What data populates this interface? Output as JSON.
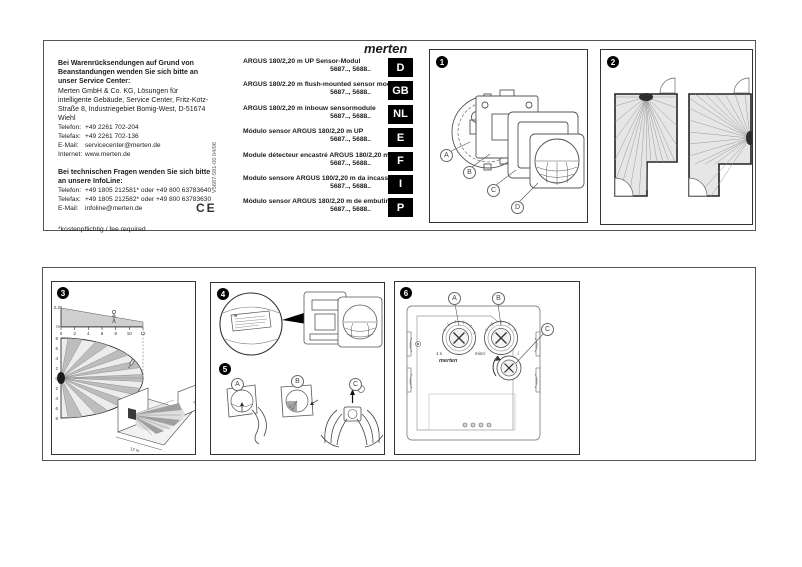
{
  "doc": {
    "vertical_code": "V5687-581-00  04/06",
    "ce_mark": "CE",
    "brand_logo": "merten"
  },
  "service_block": {
    "returns_header": "Bei Warenrücksendungen auf Grund von Beanstandungen wenden Sie sich bitte an unser Service Center:",
    "address": "Merten GmbH & Co. KG, Lösungen für intelligente Gebäude, Service Center, Fritz-Kotz-Straße 8, Industriegebiet Bomig-West, D-51674 Wiehl",
    "contacts": [
      {
        "label": "Telefon:",
        "value": "+49 2261 702-204"
      },
      {
        "label": "Telefax:",
        "value": "+49 2261 702-136"
      },
      {
        "label": "E-Mail:",
        "value": "servicecenter@merten.de"
      },
      {
        "label": "Internet:",
        "value": "www.merten.de"
      }
    ],
    "infoline_header": "Bei technischen Fragen wenden Sie sich bitte an unsere InfoLine:",
    "infoline_contacts": [
      {
        "label": "Telefon:",
        "value": "+49 1805 212581* oder +49 800 63783640"
      },
      {
        "label": "Telefax:",
        "value": "+49 1805 212582* oder +49 800 63783630"
      },
      {
        "label": "E-Mail:",
        "value": "infoline@merten.de"
      }
    ],
    "footnote": "*kostenpflichtig / fee required"
  },
  "products": [
    {
      "name": "ARGUS 180/2,20 m UP Sensor-Modul",
      "models": "5687.., 5688..",
      "lang": "D"
    },
    {
      "name": "ARGUS 180/2.20 m flush-mounted sensor module",
      "models": "5687.., 5688..",
      "lang": "GB"
    },
    {
      "name": "ARGUS 180/2,20 m inbouw sensormodule",
      "models": "5687.., 5688..",
      "lang": "NL"
    },
    {
      "name": "Módulo sensor ARGUS 180/2,20 m UP",
      "models": "5687.., 5688..",
      "lang": "E"
    },
    {
      "name": "Module détecteur encastré ARGUS 180/2,20 m",
      "models": "5687.., 5688..",
      "lang": "F"
    },
    {
      "name": "Modulo sensore ARGUS 180/2,20 m da incasso",
      "models": "5687.., 5688..",
      "lang": "I"
    },
    {
      "name": "Módulo sensor ARGUS 180/2,20 m de embutir",
      "models": "5687.., 5688..",
      "lang": "P"
    }
  ],
  "panels": {
    "p1": {
      "num": "1",
      "labels": [
        "A",
        "B",
        "C",
        "D"
      ]
    },
    "p2": {
      "num": "2"
    },
    "p3": {
      "num": "3",
      "mount_height_label": "2,2",
      "unit_label": "m",
      "xticks": [
        "0",
        "2",
        "4",
        "6",
        "8",
        "10",
        "12"
      ],
      "yticks": [
        "8",
        "6",
        "4",
        "2",
        "0",
        "2",
        "4",
        "6",
        "8"
      ],
      "corridor_length": "12 m",
      "corridor_height": "2,20 m"
    },
    "p4": {
      "num": "4"
    },
    "p5": {
      "num": "5",
      "steps": [
        "A",
        "B",
        "C"
      ]
    },
    "p6": {
      "num": "6",
      "labels": [
        "A",
        "B",
        "C"
      ],
      "knob_a_min": "1 s",
      "knob_a_max": "min",
      "sun_symbol": "☼",
      "moon_symbol": "☾",
      "brand": "merten"
    }
  },
  "colors": {
    "ink": "#1c1c1c",
    "badge_bg": "#000000",
    "diagram_fill": "#e6e6e6"
  }
}
